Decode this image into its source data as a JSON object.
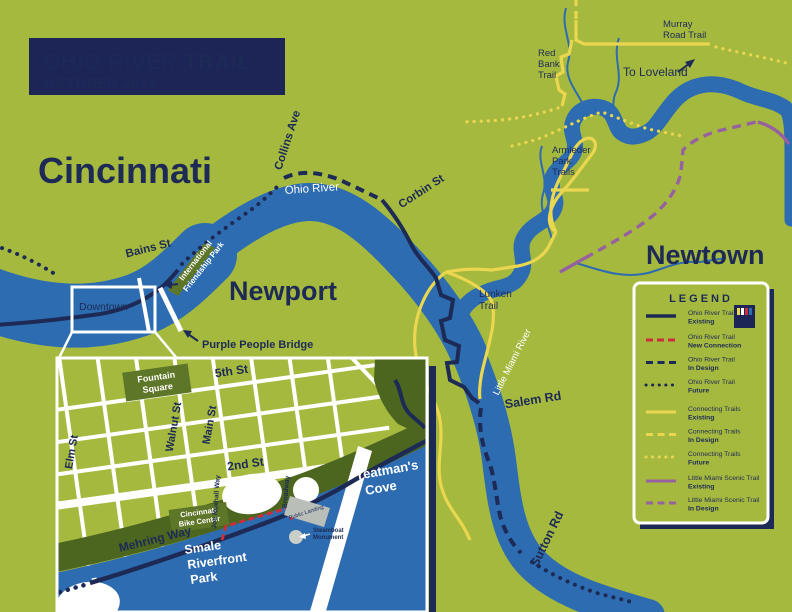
{
  "title": {
    "line1_regular": "OHIO RIVER ",
    "line1_bold": "TRAIL",
    "line2": "OCTOBER 2013"
  },
  "colors": {
    "background_green": "#a6b93f",
    "river_blue": "#2d6cb0",
    "navy": "#1d2a55",
    "trail_yellow": "#ead74f",
    "trail_red": "#c9303a",
    "trail_purple": "#96619f",
    "park_dark_green": "#5e7627",
    "riverfront_green": "#4c661f",
    "white": "#ffffff"
  },
  "map_labels": {
    "cincinnati": "Cincinnati",
    "newport": "Newport",
    "newtown": "Newtown",
    "downtown": "Downtown",
    "ohio_river": "Ohio River",
    "little_miami_river": "Little Miami River",
    "bains_st": "Bains St",
    "collins_ave": "Collins Ave",
    "corbin_st": "Corbin St",
    "salem_rd": "Salem Rd",
    "sutton_rd": "Sutton Rd",
    "purple_people_bridge": "Purple People Bridge",
    "to_loveland": "To Loveland",
    "lunken_trail": [
      "Lunken",
      "Trail"
    ],
    "armleder": [
      "Armleder",
      "Park",
      "Trails"
    ],
    "red_bank_trail": [
      "Red",
      "Bank",
      "Trail"
    ],
    "murray_road_trail": [
      "Murray",
      "Road Trail"
    ],
    "friendship_park": [
      "International",
      "Friendship Park"
    ]
  },
  "inset": {
    "labels": {
      "fountain_square": [
        "Fountain",
        "Square"
      ],
      "fifth_st": "5th St",
      "second_st": "2nd St",
      "walnut_st": "Walnut St",
      "main_st": "Main St",
      "elm_st": "Elm St",
      "joe_nuxhall_way": "Joe Nuxhall Way",
      "broadway": "Broadway",
      "yeatmans_cove": [
        "Yeatman's",
        "Cove"
      ],
      "cincinnati_bike_center": [
        "Cincinnati",
        "Bike Center"
      ],
      "mehring_way": "Mehring Way",
      "smale": [
        "Smale",
        "Riverfront",
        "Park"
      ],
      "public_landing": "Public Landing",
      "steamboat_monument": [
        "Steamboat",
        "Monument"
      ]
    }
  },
  "legend": {
    "title": "LEGEND",
    "badge": {
      "line1": "OHIO RIVER",
      "line2": "TRAIL"
    },
    "items": [
      {
        "line1": "Ohio River Trail",
        "line2": "Existing"
      },
      {
        "line1": "Ohio River Trail",
        "line2": "New Connection"
      },
      {
        "line1": "Ohio River Trail",
        "line2": "In Design"
      },
      {
        "line1": "Ohio River Trail",
        "line2": "Future"
      },
      {
        "line1": "Connecting Trails",
        "line2": "Existing"
      },
      {
        "line1": "Connecting Trails",
        "line2": "In Design"
      },
      {
        "line1": "Connecting Trails",
        "line2": "Future"
      },
      {
        "line1": "Little Miami Scenic Trail",
        "line2": "Existing"
      },
      {
        "line1": "Little Miami Scenic Trail",
        "line2": "In Design"
      }
    ]
  }
}
